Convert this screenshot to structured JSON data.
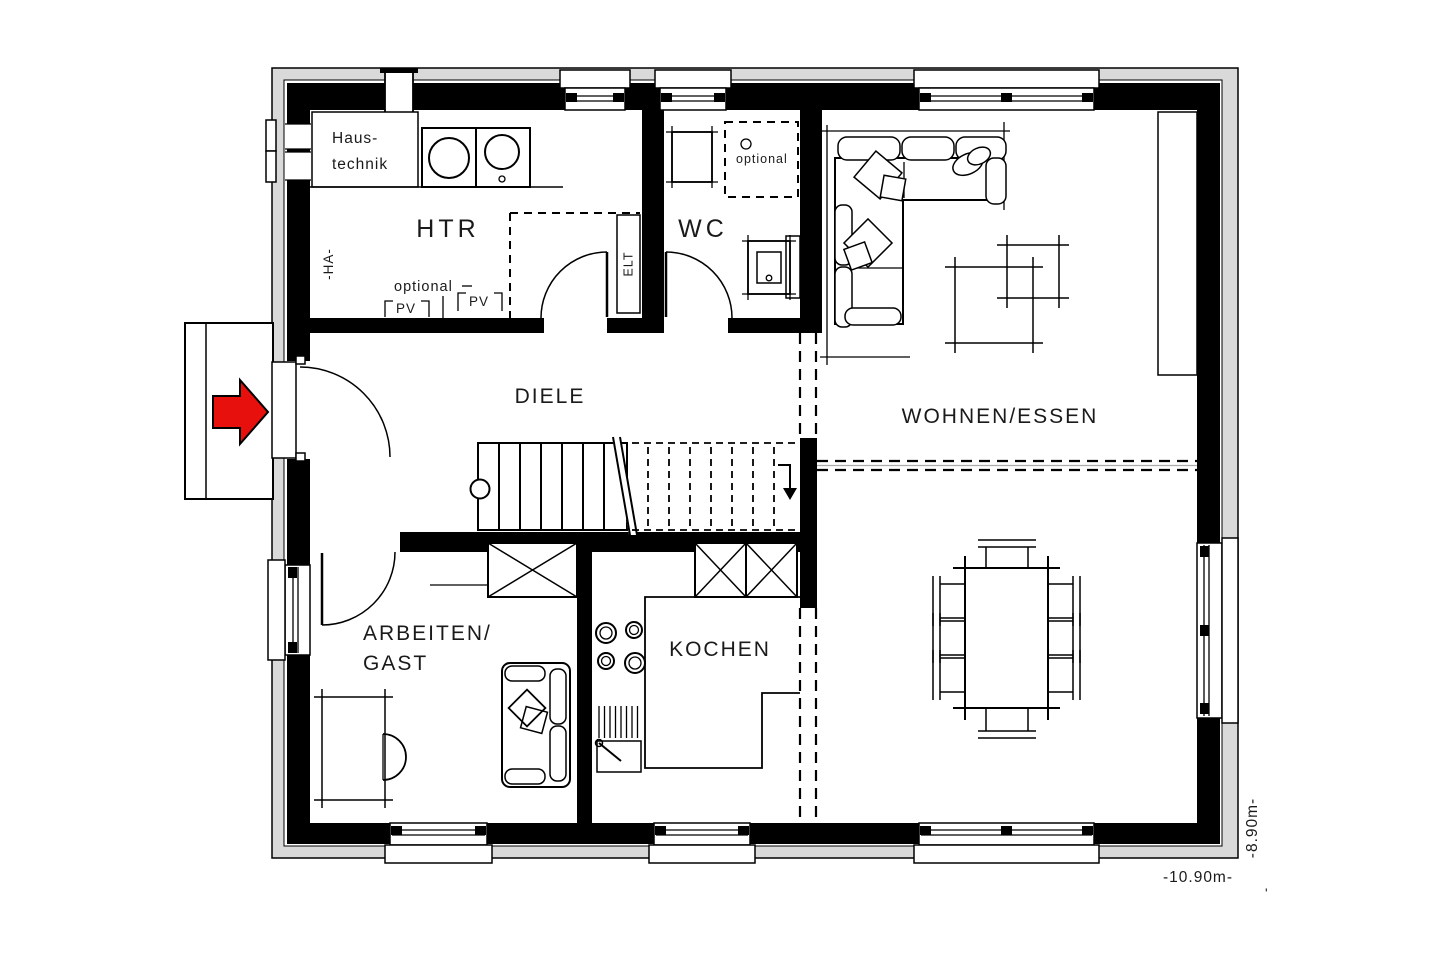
{
  "floor_plan": {
    "rooms": {
      "haustechnik": [
        "Haus-",
        "technik"
      ],
      "htr": "HTR",
      "wc": "WC",
      "diele": "DIELE",
      "wohnen_essen": "WOHNEN/ESSEN",
      "arbeiten_gast": [
        "ARBEITEN/",
        "GAST"
      ],
      "kochen": "KOCHEN"
    },
    "annotations": {
      "optional_htr": "optional",
      "pv_1": "PV",
      "pv_2": "PV",
      "elt": "ELT",
      "ha": "-HA-",
      "optional_wc": "optional",
      "stray_mark": "'"
    },
    "dimensions": {
      "width": "-10.90m-",
      "height": "-8.90m-"
    },
    "colors": {
      "entrance_arrow": "#e8100c",
      "walls": "#000000",
      "frame": "#d9d9d9"
    }
  }
}
